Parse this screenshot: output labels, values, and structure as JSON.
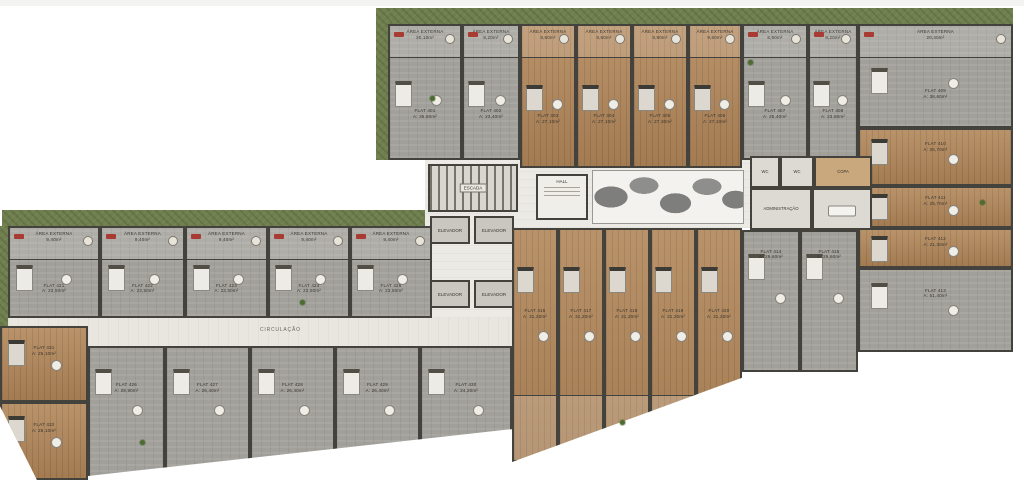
{
  "plan": {
    "corridor_label": "CIRCULAÇÃO",
    "hall_sign": "HALL",
    "stairs_label": "ESCADA",
    "elevator_label": "ELEVADOR",
    "elevator_count": 4,
    "balcony_label": "ÁREA EXTERNA",
    "admin": {
      "wc1": "WC",
      "wc2": "WC",
      "copa": "COPA",
      "office": "ADMINISTRAÇÃO",
      "meeting": "SALA"
    },
    "colors": {
      "lawn": "#6f7f4e",
      "gray_floor": "#a1a09a",
      "wood_floor": "#b18659",
      "wall": "#44423c",
      "corridor": "#e8e6df",
      "accent_red": "#a83b33"
    },
    "units": [
      {
        "label": "FLAT 401",
        "area": "A: 35,80m²",
        "floor": "gray",
        "balcony": "30,10m²",
        "x": 388,
        "y": 24,
        "w": 74,
        "h": 136
      },
      {
        "label": "FLAT 402",
        "area": "A: 23,40m²",
        "floor": "gray",
        "balcony": "8,20m²",
        "x": 462,
        "y": 24,
        "w": 58,
        "h": 136
      },
      {
        "label": "FLAT 403",
        "area": "A: 27,10m²",
        "floor": "wood",
        "balcony": "9,60m²",
        "x": 520,
        "y": 24,
        "w": 56,
        "h": 144
      },
      {
        "label": "FLAT 404",
        "area": "A: 27,10m²",
        "floor": "wood",
        "balcony": "9,60m²",
        "x": 576,
        "y": 24,
        "w": 56,
        "h": 144
      },
      {
        "label": "FLAT 405",
        "area": "A: 27,30m²",
        "floor": "wood",
        "balcony": "9,80m²",
        "x": 632,
        "y": 24,
        "w": 56,
        "h": 144
      },
      {
        "label": "FLAT 406",
        "area": "A: 27,10m²",
        "floor": "wood",
        "balcony": "9,60m²",
        "x": 688,
        "y": 24,
        "w": 54,
        "h": 144
      },
      {
        "label": "FLAT 407",
        "area": "A: 25,40m²",
        "floor": "gray",
        "balcony": "8,90m²",
        "x": 742,
        "y": 24,
        "w": 66,
        "h": 136
      },
      {
        "label": "FLAT 408",
        "area": "A: 23,80m²",
        "floor": "gray",
        "balcony": "8,20m²",
        "x": 808,
        "y": 24,
        "w": 50,
        "h": 136
      },
      {
        "label": "FLAT 409",
        "area": "A: 38,60m²",
        "floor": "gray",
        "balcony": "20,40m²",
        "x": 858,
        "y": 24,
        "w": 155,
        "h": 104
      },
      {
        "label": "FLAT 410",
        "area": "A: 25,70m²",
        "floor": "wood",
        "x": 858,
        "y": 128,
        "w": 155,
        "h": 58,
        "ly": 20
      },
      {
        "label": "FLAT 411",
        "area": "A: 25,70m²",
        "floor": "wood",
        "x": 858,
        "y": 186,
        "w": 155,
        "h": 42,
        "ly": 18
      },
      {
        "label": "FLAT 412",
        "area": "A: 21,30m²",
        "floor": "wood",
        "x": 858,
        "y": 228,
        "w": 155,
        "h": 40,
        "ly": 18
      },
      {
        "label": "FLAT 413",
        "area": "A: 61,40m²",
        "floor": "gray",
        "x": 858,
        "y": 268,
        "w": 155,
        "h": 84,
        "ly": 22
      },
      {
        "label": "FLAT 414",
        "area": "A: 29,60m²",
        "floor": "gray",
        "x": 742,
        "y": 230,
        "w": 58,
        "h": 142,
        "ly": 12
      },
      {
        "label": "FLAT 415",
        "area": "A: 29,60m²",
        "floor": "gray",
        "x": 800,
        "y": 230,
        "w": 58,
        "h": 142,
        "ly": 12
      },
      {
        "label": "FLAT 416",
        "area": "A: 31,20m²",
        "floor": "wood",
        "x": 0,
        "y": 0,
        "w": 46,
        "h": 234,
        "ly": 34,
        "g": "bm"
      },
      {
        "label": "FLAT 417",
        "area": "A: 31,20m²",
        "floor": "wood",
        "x": 46,
        "y": 0,
        "w": 46,
        "h": 234,
        "ly": 34,
        "g": "bm"
      },
      {
        "label": "FLAT 418",
        "area": "A: 31,20m²",
        "floor": "wood",
        "x": 92,
        "y": 0,
        "w": 46,
        "h": 234,
        "ly": 34,
        "g": "bm"
      },
      {
        "label": "FLAT 419",
        "area": "A: 31,20m²",
        "floor": "wood",
        "x": 138,
        "y": 0,
        "w": 46,
        "h": 234,
        "ly": 34,
        "g": "bm"
      },
      {
        "label": "FLAT 420",
        "area": "A: 31,20m²",
        "floor": "wood",
        "x": 184,
        "y": 0,
        "w": 46,
        "h": 234,
        "ly": 34,
        "g": "bm"
      },
      {
        "label": "FLAT 421",
        "area": "A: 23,50m²",
        "floor": "gray",
        "balcony": "9,40m²",
        "x": 8,
        "y": 226,
        "w": 92,
        "h": 92
      },
      {
        "label": "FLAT 422",
        "area": "A: 23,50m²",
        "floor": "gray",
        "balcony": "9,40m²",
        "x": 100,
        "y": 226,
        "w": 85,
        "h": 92
      },
      {
        "label": "FLAT 423",
        "area": "A: 23,50m²",
        "floor": "gray",
        "balcony": "9,40m²",
        "x": 185,
        "y": 226,
        "w": 83,
        "h": 92
      },
      {
        "label": "FLAT 424",
        "area": "A: 23,50m²",
        "floor": "gray",
        "balcony": "9,40m²",
        "x": 268,
        "y": 226,
        "w": 82,
        "h": 92
      },
      {
        "label": "FLAT 425",
        "area": "A: 23,50m²",
        "floor": "gray",
        "balcony": "9,40m²",
        "x": 350,
        "y": 226,
        "w": 82,
        "h": 92
      },
      {
        "label": "FLAT 426",
        "area": "A: 28,90m²",
        "floor": "gray",
        "x": 0,
        "y": 0,
        "w": 77,
        "h": 134,
        "ly": 26,
        "g": "lb"
      },
      {
        "label": "FLAT 427",
        "area": "A: 26,40m²",
        "floor": "gray",
        "x": 77,
        "y": 0,
        "w": 85,
        "h": 134,
        "ly": 26,
        "g": "lb"
      },
      {
        "label": "FLAT 428",
        "area": "A: 26,40m²",
        "floor": "gray",
        "x": 162,
        "y": 0,
        "w": 85,
        "h": 134,
        "ly": 26,
        "g": "lb"
      },
      {
        "label": "FLAT 429",
        "area": "A: 26,40m²",
        "floor": "gray",
        "x": 247,
        "y": 0,
        "w": 85,
        "h": 134,
        "ly": 26,
        "g": "lb"
      },
      {
        "label": "FLAT 430",
        "area": "A: 24,20m²",
        "floor": "gray",
        "x": 332,
        "y": 0,
        "w": 92,
        "h": 134,
        "ly": 26,
        "g": "lb"
      },
      {
        "label": "FLAT 431",
        "area": "A: 25,10m²",
        "floor": "wood",
        "x": 0,
        "y": 0,
        "w": 88,
        "h": 76,
        "ly": 24,
        "g": "lc"
      },
      {
        "label": "FLAT 432",
        "area": "A: 25,10m²",
        "floor": "wood",
        "x": 0,
        "y": 76,
        "w": 88,
        "h": 78,
        "ly": 24,
        "g": "lc"
      }
    ]
  }
}
